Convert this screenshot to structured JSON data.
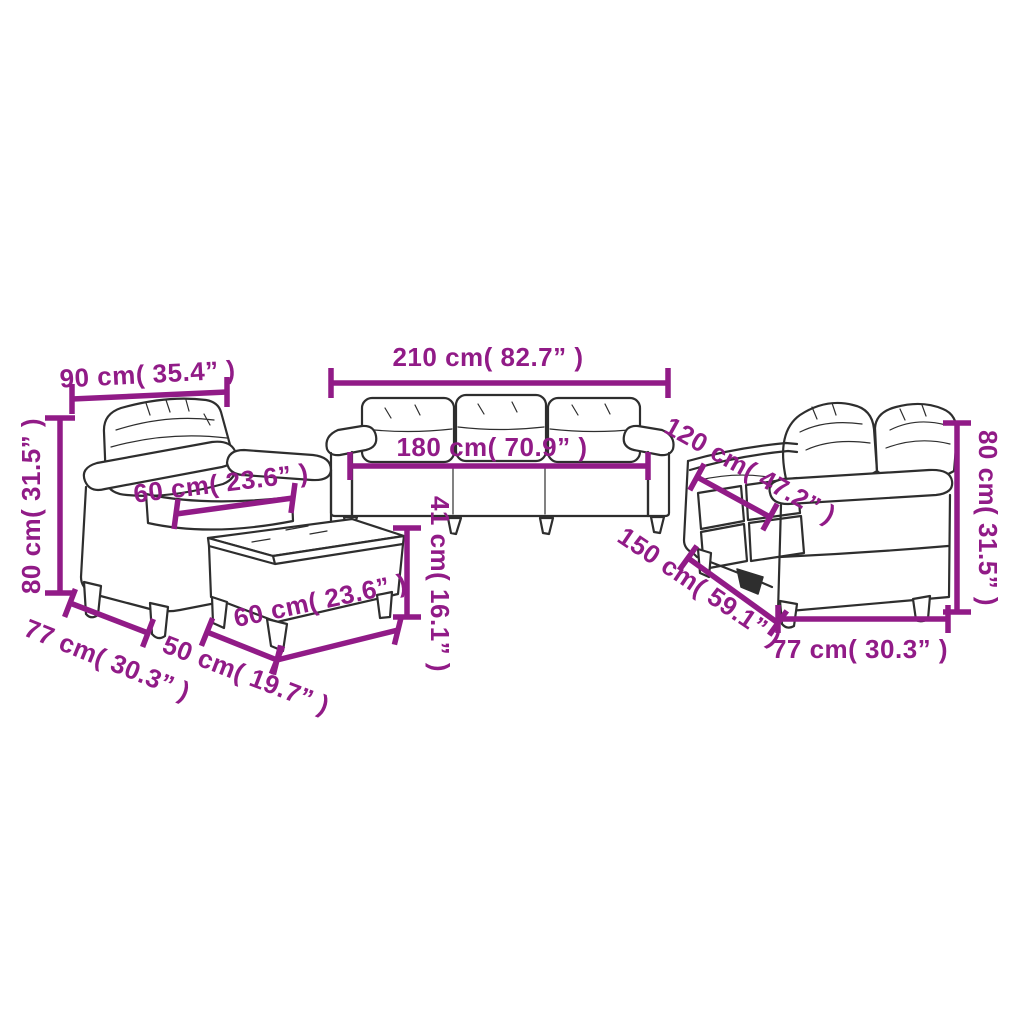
{
  "diagram": {
    "kind": "sofa-set-dimension-diagram",
    "background_color": "#ffffff",
    "accent_color": "#911b87",
    "line_color": "#2e2e2e",
    "pieces": [
      "armchair",
      "3-seater sofa",
      "footstool",
      "2-seater sofa"
    ],
    "dimensions": {
      "armchair": {
        "width": "90 cm( 35.4” )",
        "height": "80 cm( 31.5” )",
        "seat_width": "60 cm( 23.6” )",
        "depth": "77 cm( 30.3” )"
      },
      "sofa_3_seater": {
        "width": "210 cm( 82.7” )",
        "seat_width": "180 cm( 70.9” )",
        "seat_height": "41 cm( 16.1” )"
      },
      "footstool": {
        "width": "60 cm( 23.6” )",
        "depth": "50 cm( 19.7” )"
      },
      "sofa_2_seater": {
        "back_width": "120 cm( 47.2” )",
        "width": "150 cm( 59.1” )",
        "height": "80 cm( 31.5” )",
        "depth": "77 cm( 30.3” )"
      }
    }
  }
}
